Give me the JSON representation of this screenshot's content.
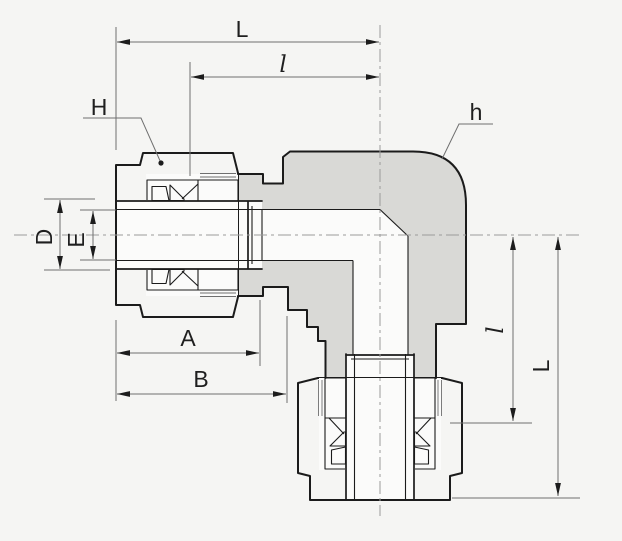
{
  "diagram": {
    "kind": "engineering cross-section drawing of a 90-degree union elbow tube fitting",
    "labels": {
      "L_top": "L",
      "l_top": "l",
      "H": "H",
      "h": "h",
      "D": "D",
      "E": "E",
      "A": "A",
      "B": "B",
      "l_right": "l",
      "L_right": "L"
    },
    "colors": {
      "background": "#f5f5f3",
      "body_fill": "#d9d9d6",
      "nut_fill": "#b4b4b1",
      "white": "#fbfbfa",
      "outline": "#1b1b1b",
      "dim_line": "#6f6f6f",
      "center_line": "#9b9b9b",
      "label": "#1f1f1f",
      "arrow": "#1c1c1c"
    }
  }
}
